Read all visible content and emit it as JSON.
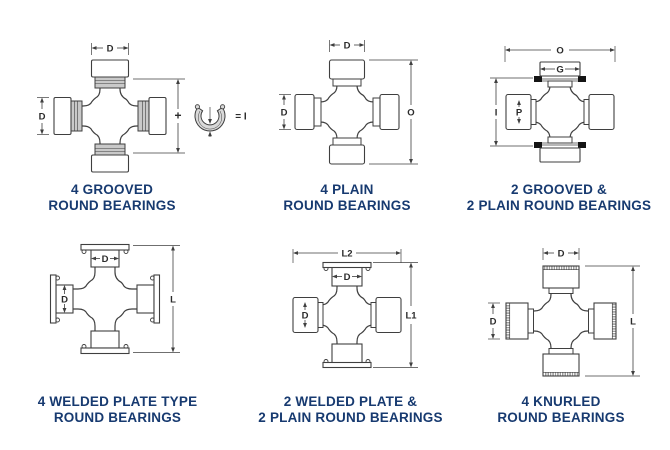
{
  "page": {
    "title": "Universal joint round bearing types",
    "background": "#ffffff"
  },
  "colors": {
    "line": "#3f3f3f",
    "dim_text": "#2b2b2b",
    "caption": "#173a70",
    "ring_fill": "#c9c9c9",
    "black_ring": "#141414",
    "fill": "#ffffff",
    "snap_ring_fill": "#d9d9d9"
  },
  "diagrams": [
    {
      "name": "4-grooved-round-bearings",
      "caption_line1": "4 GROOVED",
      "caption_line2": "ROUND BEARINGS",
      "style_v": "grooved",
      "style_h": "grooved",
      "dims": {
        "top_d": "D",
        "left_d": "D",
        "right_span": "+",
        "snap_ring_equals": "= I"
      }
    },
    {
      "name": "4-plain-round-bearings",
      "caption_line1": "4 PLAIN",
      "caption_line2": "ROUND BEARINGS",
      "style_v": "plain",
      "style_h": "plain",
      "dims": {
        "top_d": "D",
        "left_d": "D",
        "right_span": "O"
      }
    },
    {
      "name": "2-grooved-and-2-plain-round-bearings",
      "caption_line1": "2 GROOVED &",
      "caption_line2": "2 PLAIN ROUND BEARINGS",
      "style_v": "snapring",
      "style_h": "plain_short",
      "dims": {
        "top_span": "O",
        "cap_top_inner": "G",
        "left_span": "I",
        "cap_left_inner": "P"
      }
    },
    {
      "name": "4-welded-plate-type-round-bearings",
      "caption_line1": "4 WELDED PLATE TYPE",
      "caption_line2": "ROUND BEARINGS",
      "style_v": "plate",
      "style_h": "plate",
      "dims": {
        "cap_top_inner": "D",
        "cap_left_inner": "D",
        "right_span": "L"
      }
    },
    {
      "name": "2-welded-plate-and-2-plain-round-bearings",
      "caption_line1": "2 WELDED PLATE &",
      "caption_line2": "2 PLAIN ROUND BEARINGS",
      "style_v": "plate5",
      "style_h": "plain_short",
      "dims": {
        "top_span": "L2",
        "cap_top_inner": "D",
        "cap_left_inner": "D",
        "right_span": "L1"
      }
    },
    {
      "name": "4-knurled-round-bearings",
      "caption_line1": "4 KNURLED",
      "caption_line2": "ROUND BEARINGS",
      "style_v": "knurled",
      "style_h": "knurled",
      "dims": {
        "top_d": "D",
        "left_d": "D",
        "right_span": "L"
      }
    }
  ]
}
